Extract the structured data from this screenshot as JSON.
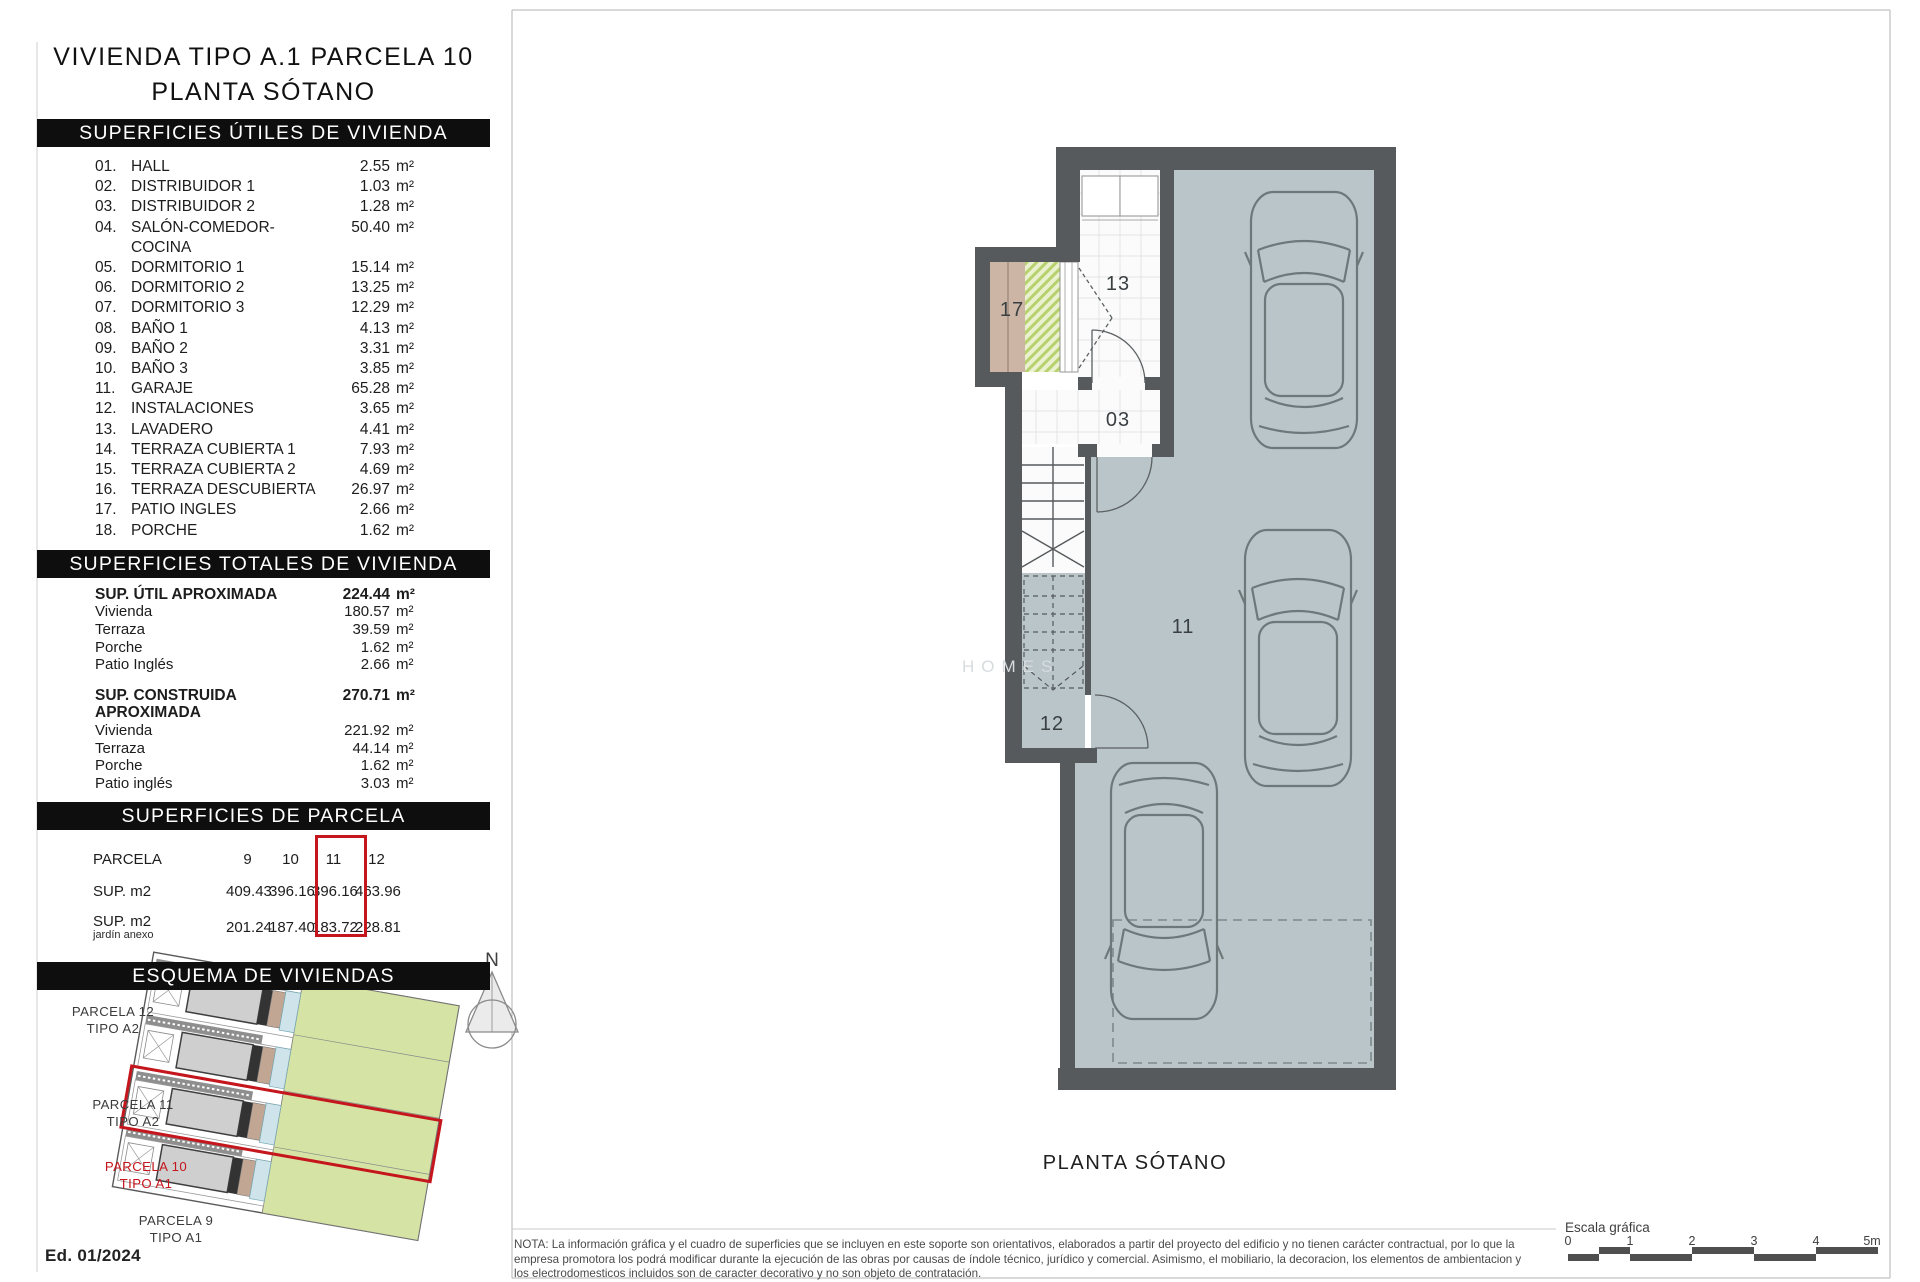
{
  "page": {
    "edition": "Ed. 01/2024",
    "plan_title": "PLANTA SÓTANO",
    "watermark": "HOMES",
    "north": "N",
    "scale": {
      "label": "Escala gráfica",
      "ticks": [
        "0",
        "1",
        "2",
        "3",
        "4",
        "5m"
      ]
    },
    "note": "NOTA: La información gráfica y el cuadro de superficies que se incluyen en este soporte son orientativos, elaborados a partir del proyecto del edificio y no tienen carácter contractual, por lo que la empresa promotora los podrá modificar durante la ejecución de las obras por causas de índole técnico, jurídico y comercial. Asimismo, el mobiliario, la decoracion, los elementos de ambientacion y los electrodomesticos incluidos son de caracter decorativo y no son objeto de contratación."
  },
  "title": {
    "line1": "VIVIENDA TIPO A.1 PARCELA 10",
    "line2": "PLANTA SÓTANO"
  },
  "utiles": {
    "header": "SUPERFICIES ÚTILES DE VIVIENDA",
    "unit": "m²",
    "rows": [
      {
        "n": "01",
        "name": "HALL",
        "v": "2.55"
      },
      {
        "n": "02",
        "name": "DISTRIBUIDOR 1",
        "v": "1.03"
      },
      {
        "n": "03",
        "name": "DISTRIBUIDOR 2",
        "v": "1.28"
      },
      {
        "n": "04",
        "name": "SALÓN-COMEDOR-COCINA",
        "v": "50.40"
      },
      {
        "n": "05",
        "name": "DORMITORIO 1",
        "v": "15.14"
      },
      {
        "n": "06",
        "name": "DORMITORIO 2",
        "v": "13.25"
      },
      {
        "n": "07",
        "name": "DORMITORIO 3",
        "v": "12.29"
      },
      {
        "n": "08",
        "name": "BAÑO 1",
        "v": "4.13"
      },
      {
        "n": "09",
        "name": "BAÑO 2",
        "v": "3.31"
      },
      {
        "n": "10",
        "name": "BAÑO 3",
        "v": "3.85"
      },
      {
        "n": "11",
        "name": "GARAJE",
        "v": "65.28"
      },
      {
        "n": "12",
        "name": "INSTALACIONES",
        "v": "3.65"
      },
      {
        "n": "13",
        "name": "LAVADERO",
        "v": "4.41"
      },
      {
        "n": "14",
        "name": "TERRAZA CUBIERTA 1",
        "v": "7.93"
      },
      {
        "n": "15",
        "name": "TERRAZA CUBIERTA 2",
        "v": "4.69"
      },
      {
        "n": "16",
        "name": "TERRAZA DESCUBIERTA",
        "v": "26.97"
      },
      {
        "n": "17",
        "name": "PATIO INGLES",
        "v": "2.66"
      },
      {
        "n": "18",
        "name": "PORCHE",
        "v": "1.62"
      }
    ]
  },
  "totales": {
    "header": "SUPERFICIES TOTALES DE VIVIENDA",
    "unit": "m²",
    "groups": [
      {
        "label": "SUP. ÚTIL APROXIMADA",
        "value": "224.44",
        "rows": [
          {
            "name": "Vivienda",
            "v": "180.57"
          },
          {
            "name": "Terraza",
            "v": "39.59"
          },
          {
            "name": "Porche",
            "v": "1.62"
          },
          {
            "name": "Patio Inglés",
            "v": "2.66"
          }
        ]
      },
      {
        "label": "SUP. CONSTRUIDA APROXIMADA",
        "value": "270.71",
        "rows": [
          {
            "name": "Vivienda",
            "v": "221.92"
          },
          {
            "name": "Terraza",
            "v": "44.14"
          },
          {
            "name": "Porche",
            "v": "1.62"
          },
          {
            "name": "Patio inglés",
            "v": "3.03"
          }
        ]
      }
    ]
  },
  "parcela": {
    "header": "SUPERFICIES DE PARCELA",
    "row1_label": "PARCELA",
    "row2_label": "SUP. m2",
    "row3_label": "SUP. m2",
    "row3_sub": "jardín anexo",
    "columns": [
      "9",
      "10",
      "11",
      "12"
    ],
    "sup": [
      "409.43",
      "396.16",
      "396.16",
      "463.96"
    ],
    "jardin": [
      "201.24",
      "187.40",
      "183.72",
      "228.81"
    ],
    "highlight_column": "10"
  },
  "esquema": {
    "header": "ESQUEMA DE VIVIENDAS",
    "parcels": [
      {
        "line1": "PARCELA 12",
        "line2": "TIPO A2",
        "highlight": false
      },
      {
        "line1": "PARCELA 11",
        "line2": "TIPO A2",
        "highlight": false
      },
      {
        "line1": "PARCELA 10",
        "line2": "TIPO A1",
        "highlight": true
      },
      {
        "line1": "PARCELA 9",
        "line2": "TIPO A1",
        "highlight": false
      }
    ]
  },
  "plan_rooms": {
    "r17": "17",
    "r13": "13",
    "r03": "03",
    "r11": "11",
    "r12": "12"
  }
}
